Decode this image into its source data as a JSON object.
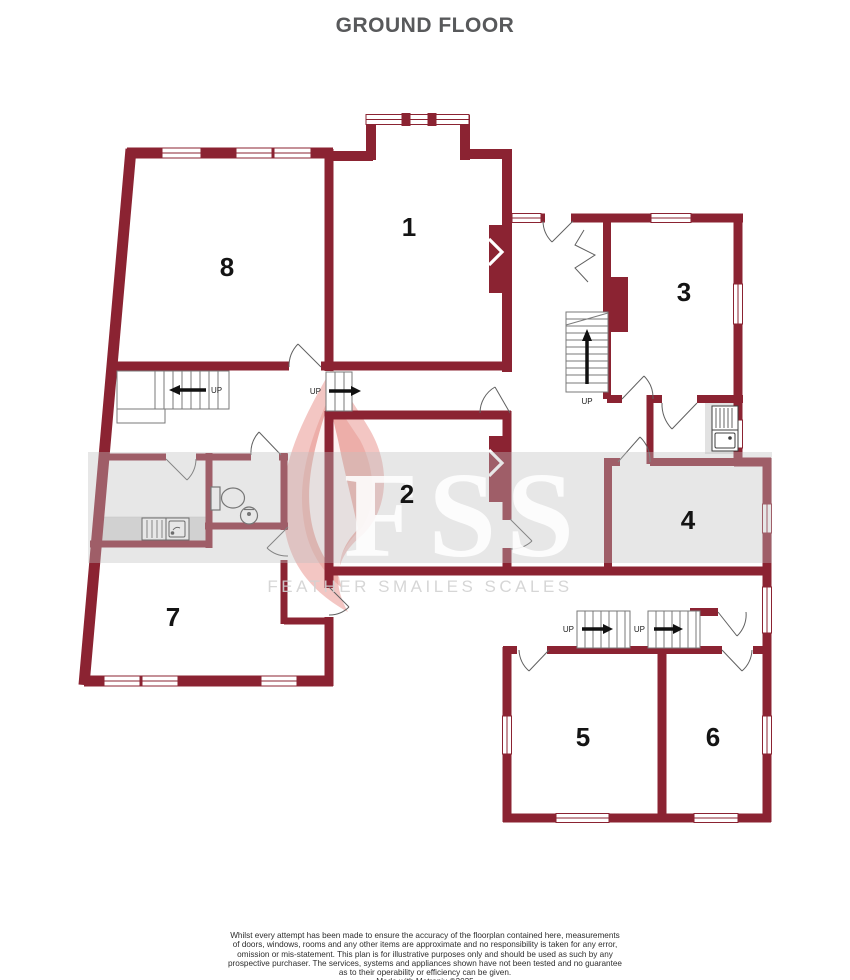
{
  "title": "GROUND FLOOR",
  "floorplan": {
    "rooms": [
      {
        "number": "1"
      },
      {
        "number": "2"
      },
      {
        "number": "3"
      },
      {
        "number": "4"
      },
      {
        "number": "5"
      },
      {
        "number": "6"
      },
      {
        "number": "7"
      },
      {
        "number": "8"
      }
    ],
    "stairs": [
      {
        "name": "lobby-stair",
        "label": "UP"
      },
      {
        "name": "hallway-step",
        "label": "UP"
      },
      {
        "name": "main-hall-stair",
        "label": "UP"
      },
      {
        "name": "rear-stair-left",
        "label": "UP"
      },
      {
        "name": "rear-stair-right",
        "label": "UP"
      }
    ],
    "colors": {
      "wall": "#8b2332",
      "counter": "#dcdcdc",
      "window_fill": "#ffffff",
      "fixture_outline": "#4a4a4a"
    }
  },
  "watermark": {
    "initials": "FSS",
    "name": "FEATHER SMAILES SCALES"
  },
  "footer": {
    "disclaimer_lines": [
      "Whilst every attempt has been made to ensure the accuracy of the floorplan contained here, measurements",
      "of doors, windows, rooms and any other items are approximate and no responsibility is taken for any error,",
      "omission or mis-statement. This plan is for illustrative purposes only and should be used as such by any",
      "prospective purchaser. The services, systems and appliances shown have not been tested and no guarantee",
      "as to their operability or efficiency can be given."
    ],
    "credit": "Made with Metropix ©2025"
  }
}
